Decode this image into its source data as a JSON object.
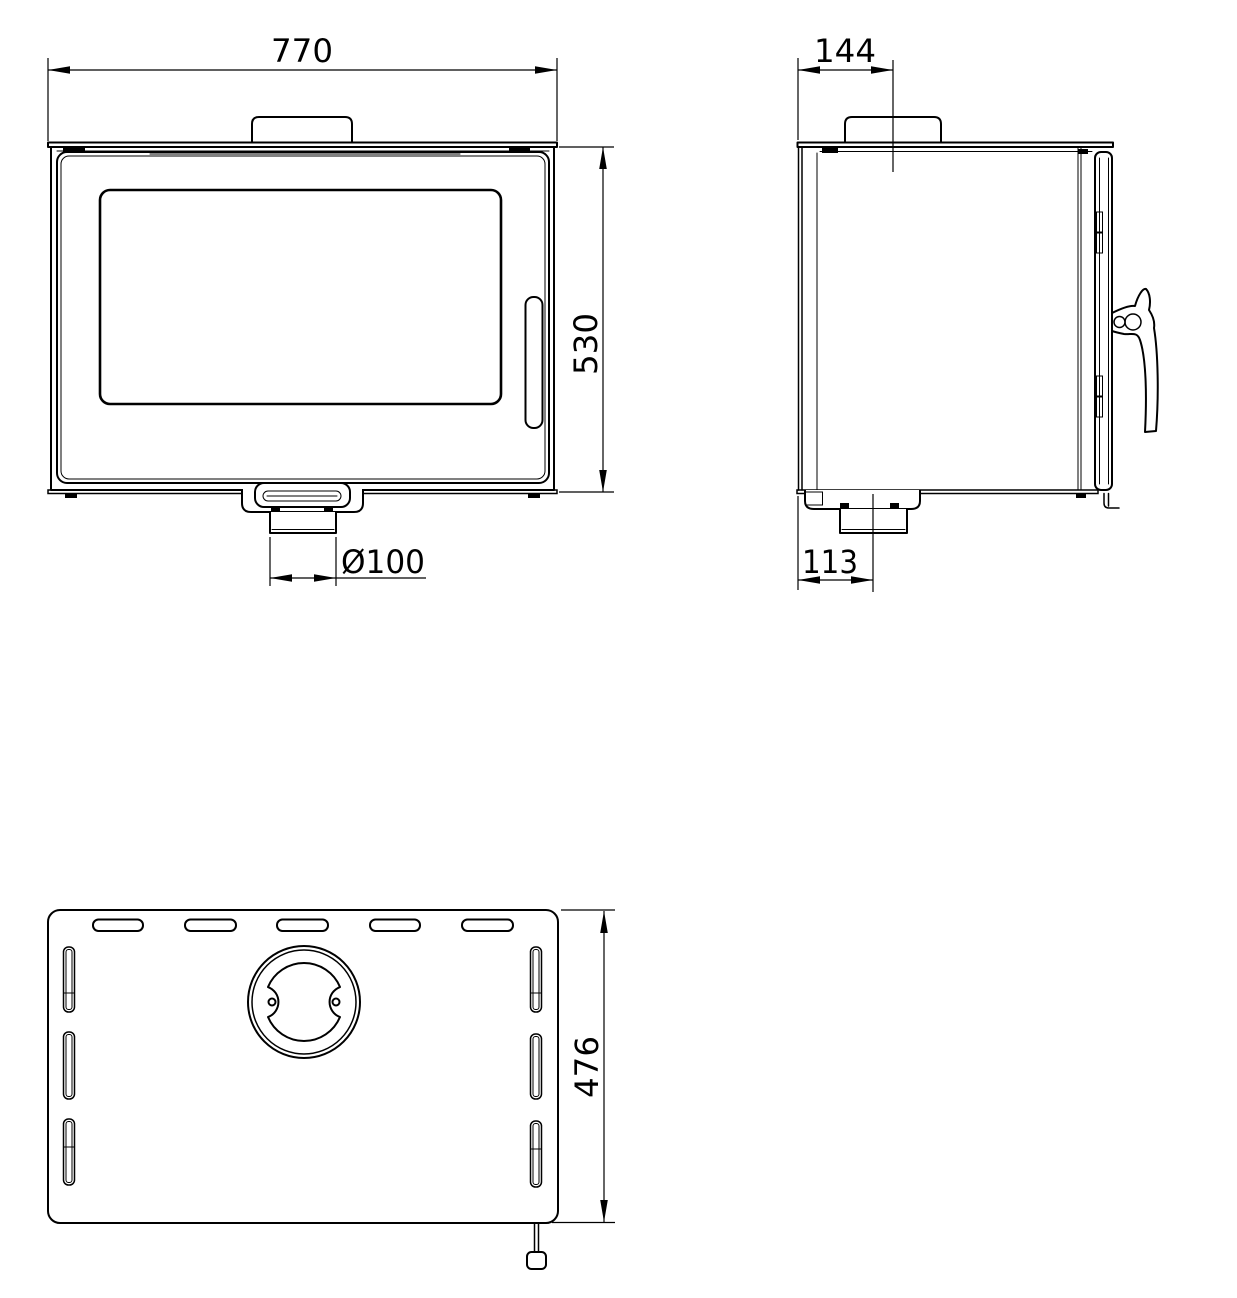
{
  "meta": {
    "background_color": "#ffffff",
    "line_color": "#000000",
    "description": "Technical dimension drawing of a wood-burning stove in three orthographic views: front view, side view and bottom (plan) view"
  },
  "dimensions": {
    "front_width": "770",
    "front_height": "530",
    "flue_spigot_diameter": "Ø100",
    "flue_collar_offset_from_back": "144",
    "bottom_outlet_offset_from_back": "113",
    "plan_depth": "476"
  }
}
